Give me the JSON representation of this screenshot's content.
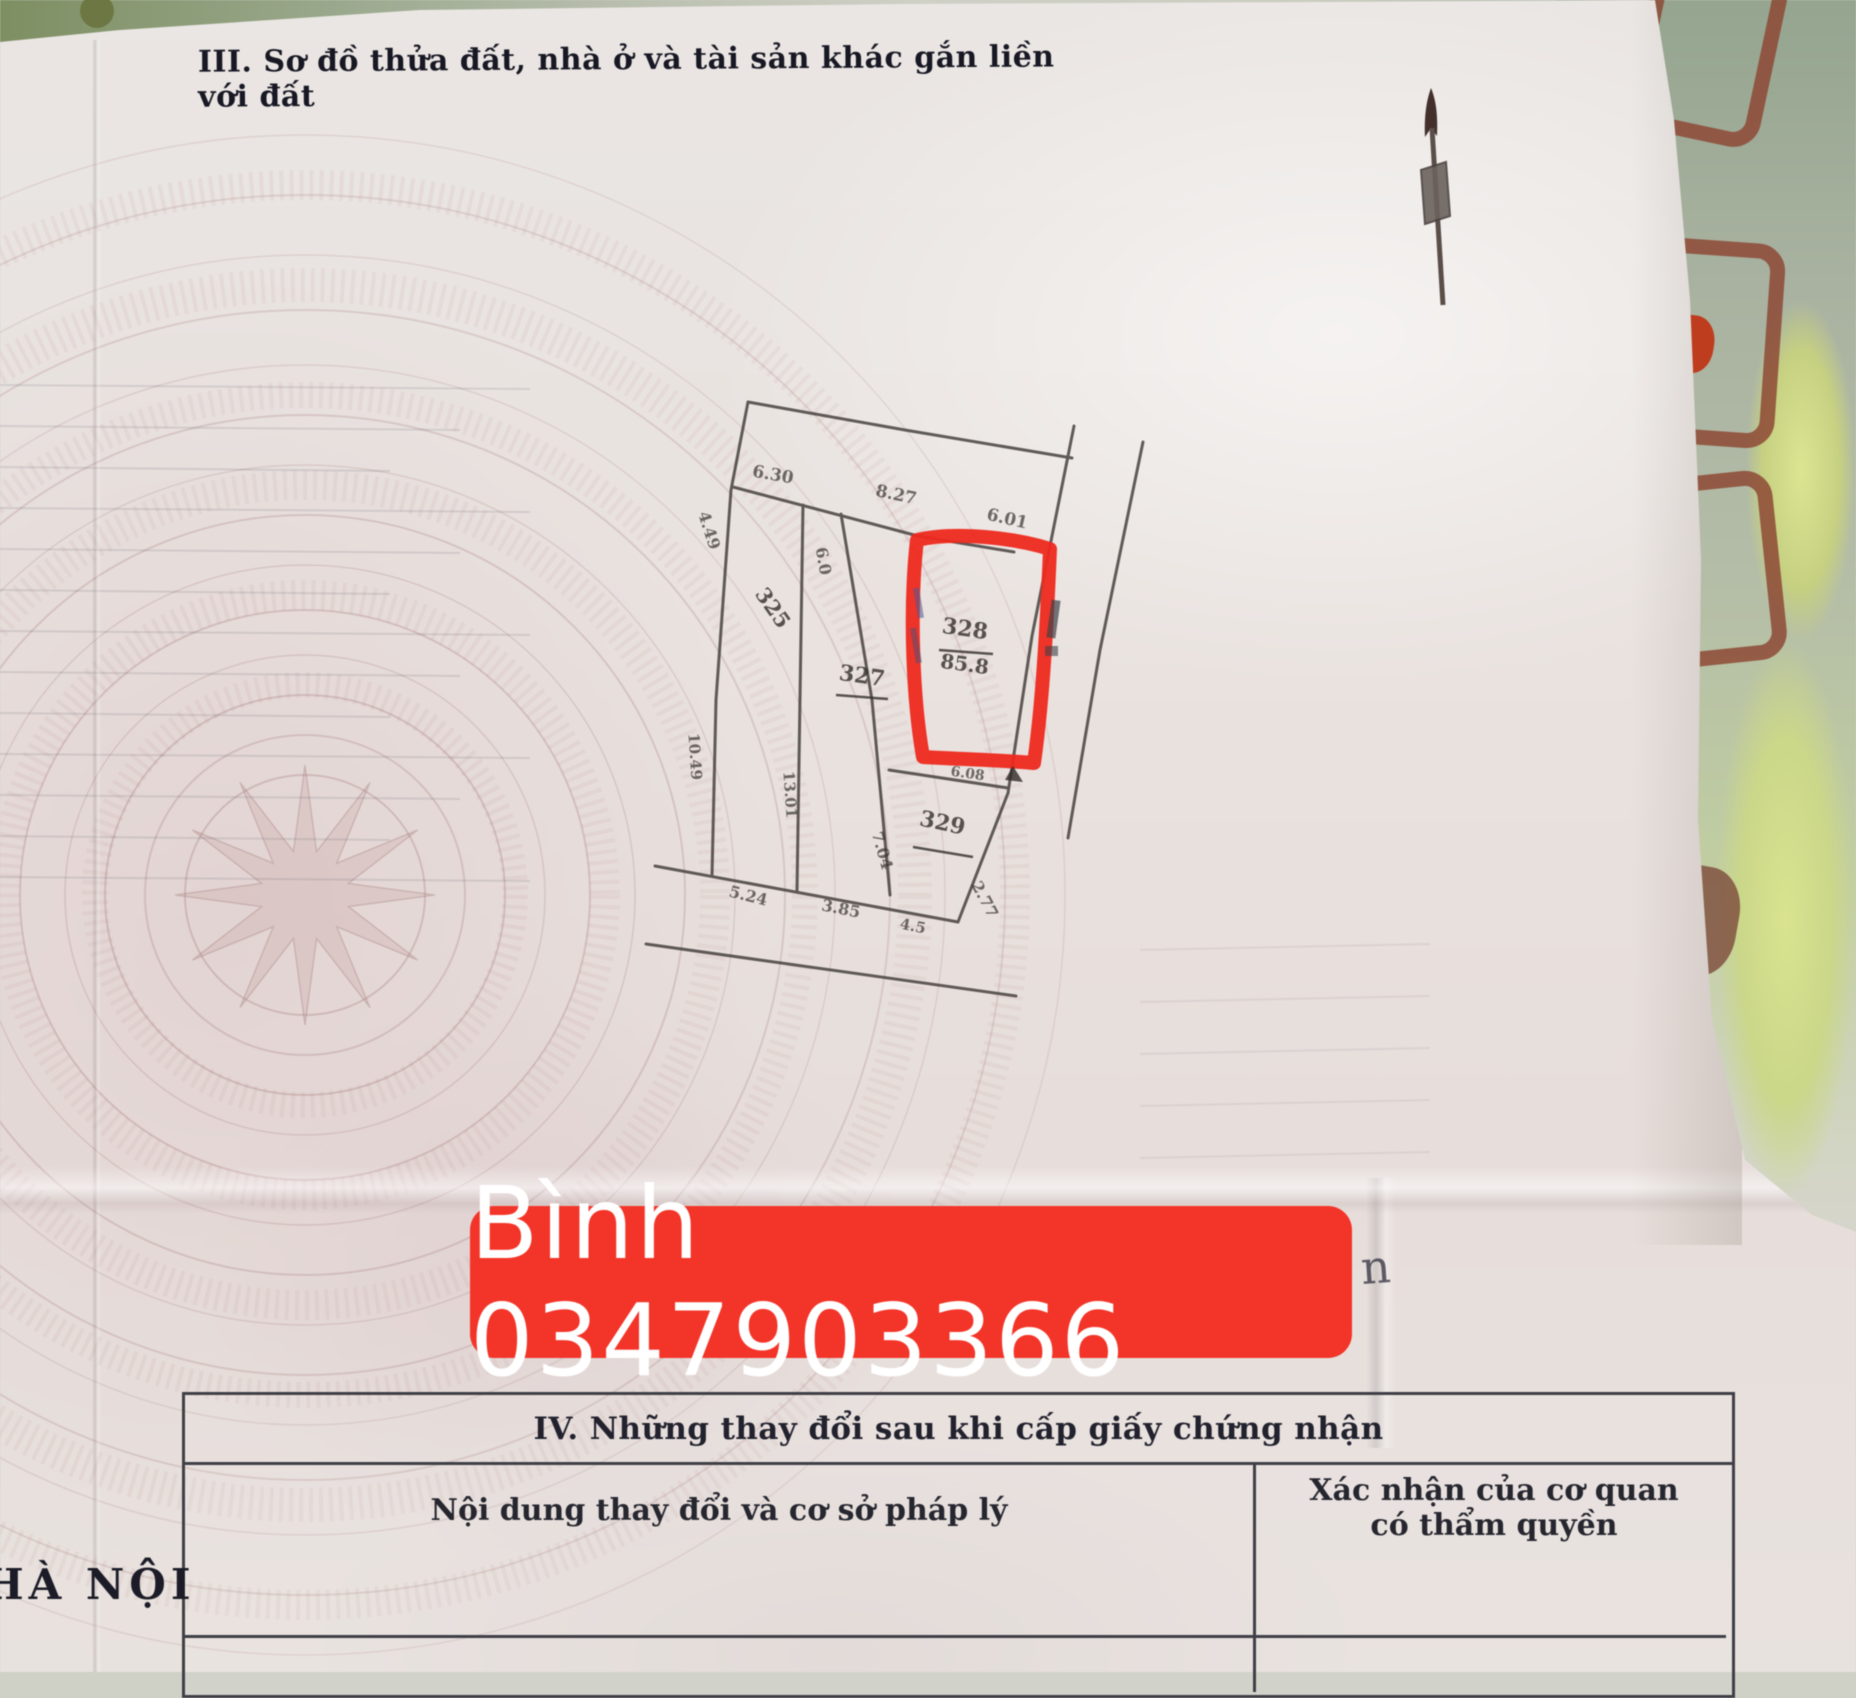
{
  "header": {
    "section_title": "III. Sơ đồ thửa đất, nhà ở và tài sản khác gắn liền với đất"
  },
  "diagram": {
    "plots": [
      {
        "number": "325"
      },
      {
        "number": "327"
      },
      {
        "number": "328",
        "area": "85.8"
      },
      {
        "number": "329"
      }
    ],
    "dims": [
      "6.30",
      "8.27",
      "6.01",
      "4.49",
      "6.0",
      "10.49",
      "13.01",
      "7.04",
      "6.08",
      "5.24",
      "3.85",
      "4.5",
      "2.77"
    ],
    "stray_mark": "n",
    "icons": {
      "north_arrow": "north-arrow-icon"
    }
  },
  "watermark": {
    "name_phone": "Bình 0347903366",
    "banner_color": "#f83326",
    "text_color": "#ffffff"
  },
  "table": {
    "title": "IV. Những thay đổi sau khi cấp giấy chứng nhận",
    "columns": {
      "left": "Nội dung thay đổi và cơ sở pháp lý",
      "right_line1": "Xác nhận của cơ quan",
      "right_line2": "có thẩm quyền"
    }
  },
  "footer": {
    "city": "HÀ NỘI"
  },
  "colors": {
    "red_outline": "#f3281b",
    "background_green": "#a2b09a",
    "background_lime": "#d6e18b",
    "paper": "#e9e3e0"
  }
}
